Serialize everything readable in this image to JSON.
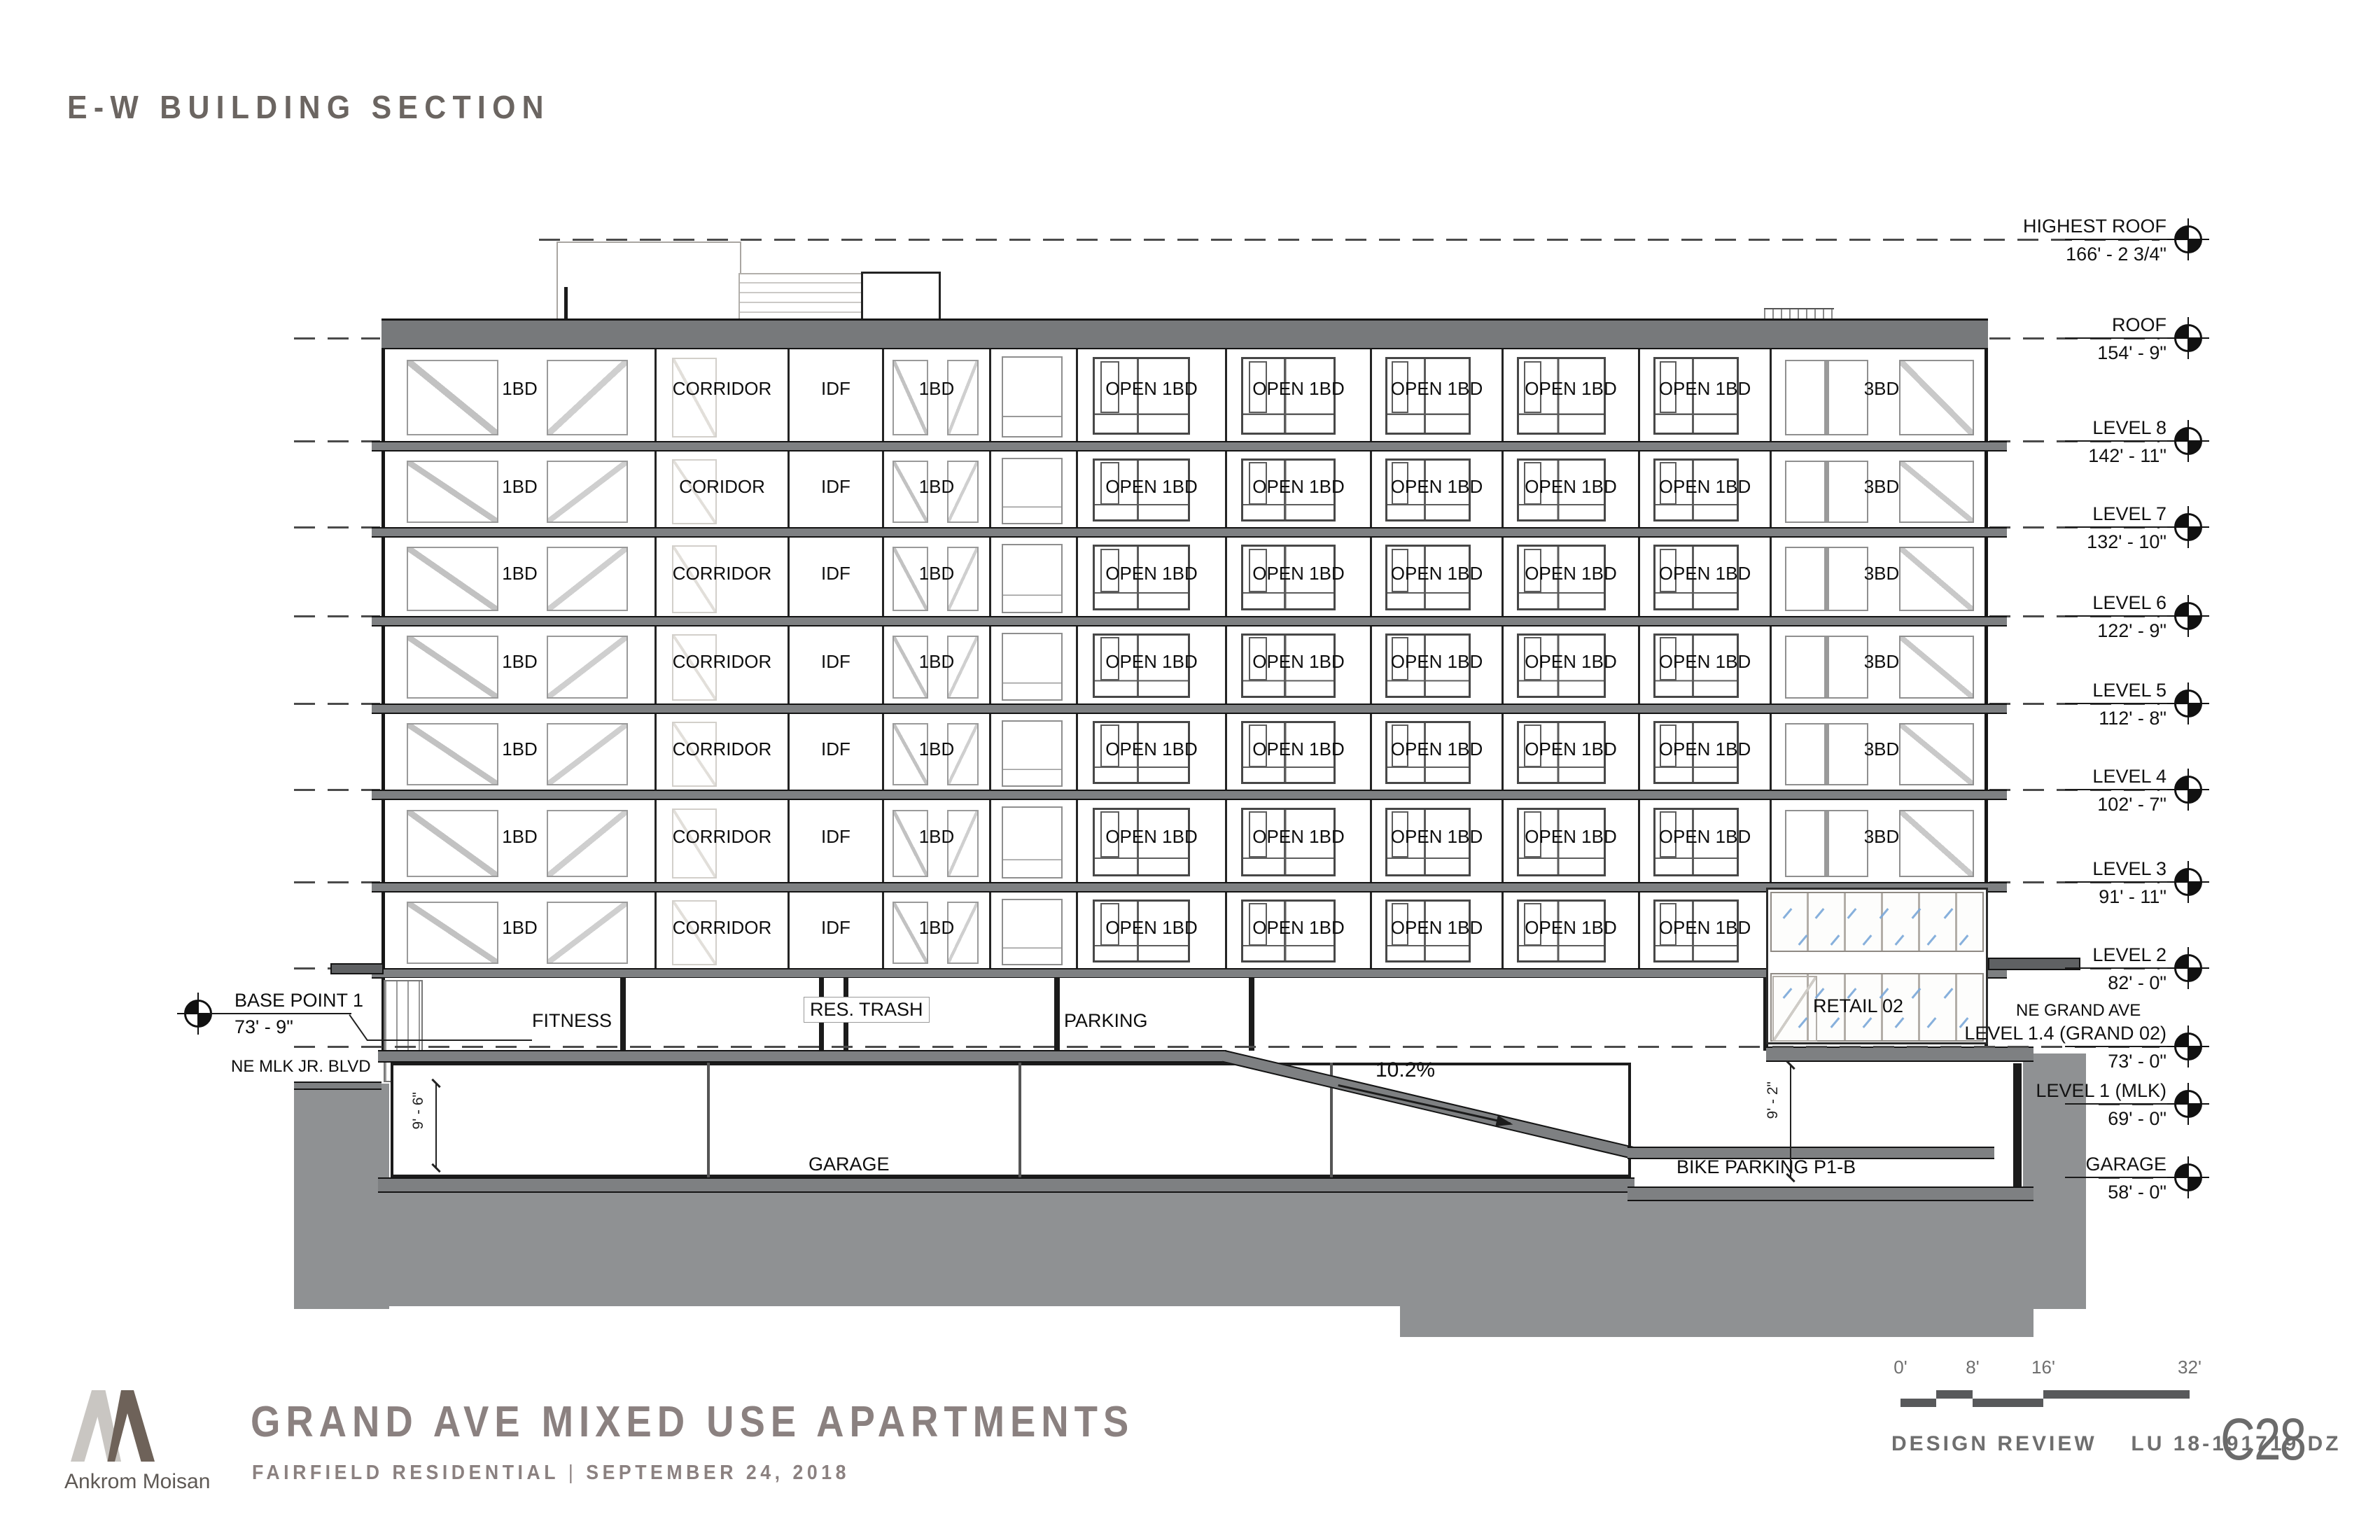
{
  "sheet": {
    "title": "E-W BUILDING SECTION",
    "sheet_number": "C28",
    "review_label": "DESIGN REVIEW",
    "permit_number": "LU 18-191719 DZ",
    "firm": "Ankrom Moisan",
    "project_title": "GRAND AVE MIXED USE APARTMENTS",
    "client": "FAIRFIELD RESIDENTIAL",
    "separator": "|",
    "date": "SEPTEMBER 24, 2018"
  },
  "colors": {
    "teal": "#56bca9",
    "ink": "#1c1c1c",
    "slab_gray": "#7e8082",
    "earth_gray": "#8f9193",
    "text_gray": "#6b6561",
    "title_gray": "#8b8180",
    "glass_blue": "#7aa7d8"
  },
  "levels": [
    {
      "name": "HIGHEST ROOF",
      "elevation": "166' - 2 3/4\""
    },
    {
      "name": "ROOF",
      "elevation": "154' - 9\""
    },
    {
      "name": "LEVEL 8",
      "elevation": "142' - 11\""
    },
    {
      "name": "LEVEL 7",
      "elevation": "132' - 10\""
    },
    {
      "name": "LEVEL 6",
      "elevation": "122' - 9\""
    },
    {
      "name": "LEVEL 5",
      "elevation": "112' - 8\""
    },
    {
      "name": "LEVEL 4",
      "elevation": "102' - 7\""
    },
    {
      "name": "LEVEL 3",
      "elevation": "91' - 11\""
    },
    {
      "name": "LEVEL 2",
      "elevation": "82' - 0\""
    },
    {
      "name": "LEVEL 1.4 (GRAND 02)",
      "elevation": "73' - 0\""
    },
    {
      "name": "LEVEL 1 (MLK)",
      "elevation": "69' - 0\""
    },
    {
      "name": "GARAGE",
      "elevation": "58' - 0\""
    }
  ],
  "floors": [
    {
      "level": "8",
      "units": [
        "1BD",
        "CORRIDOR",
        "IDF",
        "1BD",
        "",
        "OPEN 1BD",
        "OPEN 1BD",
        "OPEN 1BD",
        "OPEN 1BD",
        "OPEN 1BD",
        "3BD"
      ]
    },
    {
      "level": "7",
      "units": [
        "1BD",
        "CORIDOR",
        "IDF",
        "1BD",
        "",
        "OPEN 1BD",
        "OPEN 1BD",
        "OPEN 1BD",
        "OPEN 1BD",
        "OPEN 1BD",
        "3BD"
      ]
    },
    {
      "level": "6",
      "units": [
        "1BD",
        "CORRIDOR",
        "IDF",
        "1BD",
        "",
        "OPEN 1BD",
        "OPEN 1BD",
        "OPEN 1BD",
        "OPEN 1BD",
        "OPEN 1BD",
        "3BD"
      ]
    },
    {
      "level": "5",
      "units": [
        "1BD",
        "CORRIDOR",
        "IDF",
        "1BD",
        "",
        "OPEN 1BD",
        "OPEN 1BD",
        "OPEN 1BD",
        "OPEN 1BD",
        "OPEN 1BD",
        "3BD"
      ]
    },
    {
      "level": "4",
      "units": [
        "1BD",
        "CORRIDOR",
        "IDF",
        "1BD",
        "",
        "OPEN 1BD",
        "OPEN 1BD",
        "OPEN 1BD",
        "OPEN 1BD",
        "OPEN 1BD",
        "3BD"
      ]
    },
    {
      "level": "3",
      "units": [
        "1BD",
        "CORRIDOR",
        "IDF",
        "1BD",
        "",
        "OPEN 1BD",
        "OPEN 1BD",
        "OPEN 1BD",
        "OPEN 1BD",
        "OPEN 1BD",
        "3BD"
      ]
    },
    {
      "level": "2",
      "units": [
        "1BD",
        "CORRIDOR",
        "IDF",
        "1BD",
        "",
        "OPEN 1BD",
        "OPEN 1BD",
        "OPEN 1BD",
        "OPEN 1BD",
        "OPEN 1BD",
        ""
      ]
    }
  ],
  "ground": {
    "fitness": "FITNESS",
    "res_trash": "RES. TRASH",
    "parking": "PARKING",
    "retail": "RETAIL 02",
    "garage": "GARAGE",
    "bike_parking": "BIKE PARKING P1-B",
    "ramp_slope": "10.2%",
    "dim_garage": "9' - 6\"",
    "dim_bike": "9' - 2\"",
    "street_left": "NE MLK JR. BLVD",
    "street_right": "NE GRAND AVE",
    "base_point": {
      "label": "BASE POINT 1",
      "elevation": "73' - 9\""
    }
  },
  "scale_bar": {
    "ticks": [
      "0'",
      "8'",
      "16'",
      "32'"
    ]
  }
}
